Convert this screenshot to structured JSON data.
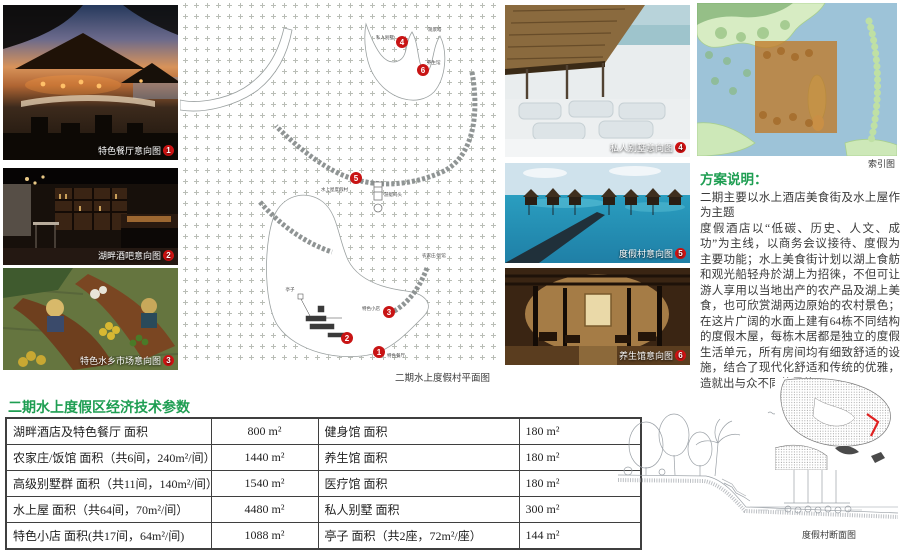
{
  "colors": {
    "accent_green": "#1e9e52",
    "marker_red": "#c81414"
  },
  "left_photos": [
    {
      "caption": "特色餐厅意向图",
      "num": "1"
    },
    {
      "caption": "湖畔酒吧意向图",
      "num": "2"
    },
    {
      "caption": "特色水乡市场意向图",
      "num": "3"
    }
  ],
  "right_photos": [
    {
      "caption": "私人别墅意向图",
      "num": "4"
    },
    {
      "caption": "度假村意向图",
      "num": "5"
    },
    {
      "caption": "养生馆意向图",
      "num": "6"
    }
  ],
  "site_plan": {
    "caption": "二期水上度假村平面图",
    "markers": [
      "1",
      "2",
      "3",
      "4",
      "5",
      "6"
    ],
    "labels": [
      "私人别墅",
      "观景塔",
      "养生馆",
      "亭子",
      "游艇码头",
      "特色餐厅",
      "特色小店",
      "农家庄/饭馆",
      "水上屋度假村"
    ]
  },
  "index_map": {
    "caption": "索引图"
  },
  "section_drawing": {
    "caption": "度假村断面图"
  },
  "description": {
    "heading": "方案说明：",
    "p1": "二期主要以水上酒店美食街及水上屋作为主题",
    "p2": "度假酒店以“低碳、历史、人文、成功”为主线，以商务会议接待、度假为主要功能；水上美食街计划以湖上食舫和观光船轻舟於湖上为招徕，不但可让游人享用以当地出产的农产品及湖上美食，也可欣赏湖两边原始的农村景色；在这片广阔的水面上建有64栋不同结构的度假木屋，每栋木居都是独立的度假生活单元，所有房间均有细致舒适的设施，结合了现代化舒适和传统的优雅，造就出与众不同的风格。"
  },
  "table": {
    "title": "二期水上度假区经济技术参数",
    "rows": [
      {
        "c1": "湖畔酒店及特色餐厅 面积",
        "v1": "800 m²",
        "c2": "健身馆 面积",
        "v2": "180 m²"
      },
      {
        "c1": "农家庄/饭馆 面积（共6间，240m²/间）",
        "v1": "1440 m²",
        "c2": "养生馆 面积",
        "v2": "180 m²"
      },
      {
        "c1": "高级别墅群 面积（共11间，140m²/间）",
        "v1": "1540 m²",
        "c2": "医疗馆 面积",
        "v2": "180 m²"
      },
      {
        "c1": "水上屋 面积（共64间，70m²/间）",
        "v1": "4480 m²",
        "c2": "私人别墅 面积",
        "v2": "300 m²"
      },
      {
        "c1": "特色小店 面积(共17间，64m²/间)",
        "v1": "1088 m²",
        "c2": "亭子 面积（共2座，72m²/座）",
        "v2": "144 m²"
      }
    ]
  }
}
